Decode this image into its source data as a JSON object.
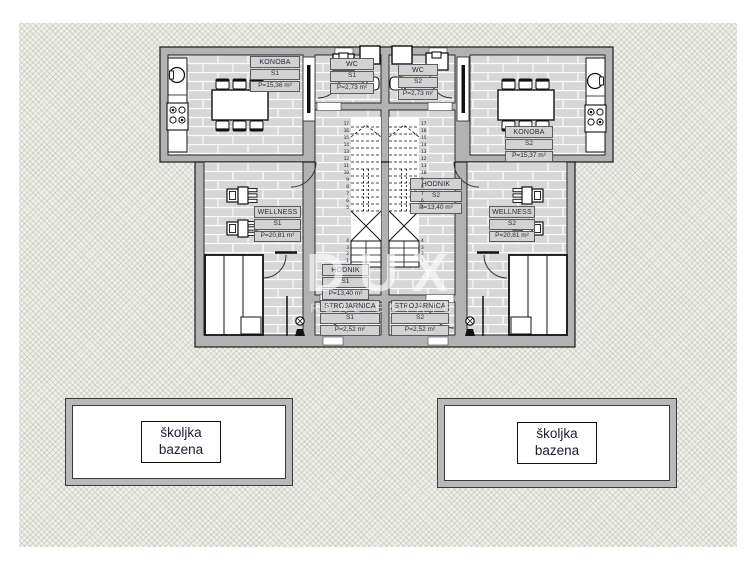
{
  "watermark": {
    "title": "DUX",
    "subtitle": "REAL ESTATE"
  },
  "rooms": {
    "konoba_s1": {
      "name": "KONOBA",
      "unit": "S1",
      "area": "P=15,36 m²"
    },
    "konoba_s2": {
      "name": "KONOBA",
      "unit": "S2",
      "area": "P=15,37 m²"
    },
    "wc_s1": {
      "name": "WC",
      "unit": "S1",
      "area": "P=2,73 m²"
    },
    "wc_s2": {
      "name": "WC",
      "unit": "S2",
      "area": "P=2,73 m²"
    },
    "wellness_s1": {
      "name": "WELLNESS",
      "unit": "S1",
      "area": "P=20,81 m²"
    },
    "wellness_s2": {
      "name": "WELLNESS",
      "unit": "S2",
      "area": "P=20,81 m²"
    },
    "hodnik_s1": {
      "name": "HODNIK",
      "unit": "S1",
      "area": "P=13,40 m²"
    },
    "hodnik_s2": {
      "name": "HODNIK",
      "unit": "S2",
      "area": "P=13,40 m²"
    },
    "strojarnica_s1": {
      "name": "STROJARNICA",
      "unit": "S1",
      "area": "P=2,52 m²"
    },
    "strojarnica_s2": {
      "name": "STROJARNICA",
      "unit": "S2",
      "area": "P=2,52 m²"
    }
  },
  "pools": {
    "left": {
      "line1": "školjka",
      "line2": "bazena"
    },
    "right": {
      "line1": "školjka",
      "line2": "bazena"
    }
  },
  "stairs": {
    "left_upper": [
      "17",
      "16",
      "15",
      "14",
      "13",
      "12",
      "11",
      "10",
      "9",
      "8",
      "7",
      "6",
      "5"
    ],
    "left_lower": [
      "4",
      "3",
      "2",
      "1"
    ],
    "right_upper": [
      "17",
      "16",
      "15",
      "14",
      "13",
      "12",
      "11",
      "10",
      "9",
      "8",
      "7",
      "6",
      "5"
    ],
    "right_lower": [
      "4",
      "3",
      "2",
      "1"
    ]
  },
  "colors": {
    "wall": "#b2b2b2",
    "floor": "#d7d7d7",
    "hatch": "#efefe9",
    "line": "#1a1a1a"
  }
}
